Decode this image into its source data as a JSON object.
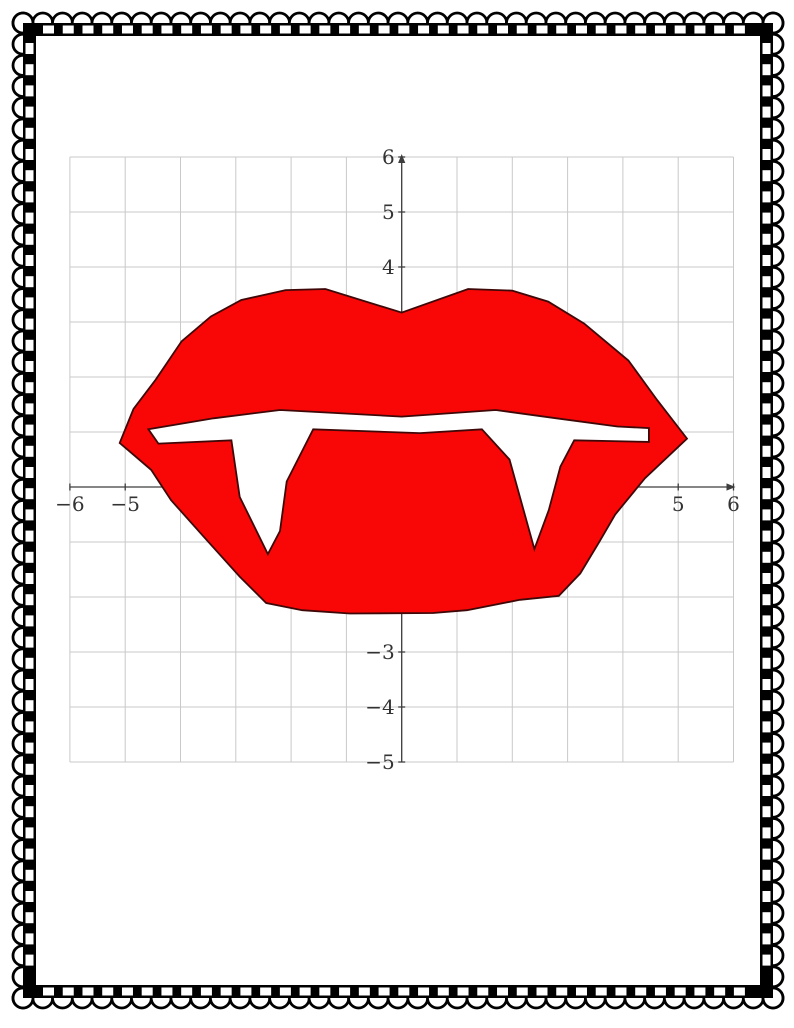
{
  "page": {
    "background_color": "#ffffff",
    "description": "Coordinate graphing worksheet page showing red vampire lips with two white fangs on a grid"
  },
  "border": {
    "name": "scalloped-lace-frame",
    "band_color": "#000000",
    "dash_color": "#ffffff",
    "scallop_fill": "#ffffff",
    "scallop_outline": "#000000"
  },
  "chart_data": {
    "type": "line",
    "subtype": "coordinate-plane-picture-closed-polygons",
    "title": "",
    "xlabel": "",
    "ylabel": "",
    "xlim": [
      -6,
      6
    ],
    "ylim": [
      -5,
      6
    ],
    "grid": true,
    "grid_step": 1,
    "grid_color": "#c9c9c9",
    "axis_color": "#3d3d3d",
    "tick_label_color": "#333333",
    "legend": "none",
    "x_tick_labels": [
      {
        "value": -6,
        "label": "−6"
      },
      {
        "value": -5,
        "label": "−5"
      },
      {
        "value": 5,
        "label": "5"
      },
      {
        "value": 6,
        "label": "6"
      }
    ],
    "y_tick_labels": [
      {
        "value": 6,
        "label": "6"
      },
      {
        "value": 5,
        "label": "5"
      },
      {
        "value": 4,
        "label": "4"
      },
      {
        "value": -3,
        "label": "−3"
      },
      {
        "value": -4,
        "label": "−4"
      },
      {
        "value": -5,
        "label": "−5"
      }
    ],
    "series": [
      {
        "name": "lips-outline",
        "closed": true,
        "fill": "#f90606",
        "stroke": "#3f0808",
        "points": [
          [
            -5.1,
            0.8
          ],
          [
            -4.85,
            1.42
          ],
          [
            -4.45,
            1.95
          ],
          [
            -3.98,
            2.65
          ],
          [
            -3.45,
            3.1
          ],
          [
            -2.9,
            3.4
          ],
          [
            -2.1,
            3.58
          ],
          [
            -1.38,
            3.6
          ],
          [
            0.0,
            3.17
          ],
          [
            1.2,
            3.6
          ],
          [
            2.0,
            3.57
          ],
          [
            2.65,
            3.37
          ],
          [
            3.3,
            2.97
          ],
          [
            4.1,
            2.3
          ],
          [
            4.62,
            1.58
          ],
          [
            5.16,
            0.88
          ],
          [
            4.4,
            0.16
          ],
          [
            3.86,
            -0.5
          ],
          [
            3.56,
            -1.02
          ],
          [
            3.23,
            -1.57
          ],
          [
            2.84,
            -1.98
          ],
          [
            2.14,
            -2.05
          ],
          [
            1.18,
            -2.24
          ],
          [
            0.57,
            -2.29
          ],
          [
            -0.94,
            -2.3
          ],
          [
            -1.8,
            -2.24
          ],
          [
            -2.45,
            -2.11
          ],
          [
            -2.93,
            -1.63
          ],
          [
            -3.53,
            -0.96
          ],
          [
            -4.17,
            -0.24
          ],
          [
            -4.53,
            0.31
          ]
        ]
      },
      {
        "name": "mouth-gap-and-fangs",
        "closed": true,
        "fill": "#ffffff",
        "stroke": "#3f0808",
        "points": [
          [
            -4.58,
            1.05
          ],
          [
            -3.4,
            1.25
          ],
          [
            -2.2,
            1.4
          ],
          [
            0.0,
            1.28
          ],
          [
            1.7,
            1.4
          ],
          [
            2.8,
            1.25
          ],
          [
            3.9,
            1.1
          ],
          [
            4.47,
            1.07
          ],
          [
            4.47,
            0.82
          ],
          [
            3.12,
            0.85
          ],
          [
            2.87,
            0.37
          ],
          [
            2.66,
            -0.42
          ],
          [
            2.4,
            -1.13
          ],
          [
            1.95,
            0.5
          ],
          [
            1.45,
            1.05
          ],
          [
            0.33,
            0.98
          ],
          [
            -1.6,
            1.05
          ],
          [
            -2.08,
            0.1
          ],
          [
            -2.2,
            -0.8
          ],
          [
            -2.42,
            -1.22
          ],
          [
            -2.93,
            -0.18
          ],
          [
            -3.08,
            0.85
          ],
          [
            -4.4,
            0.79
          ]
        ]
      }
    ]
  }
}
